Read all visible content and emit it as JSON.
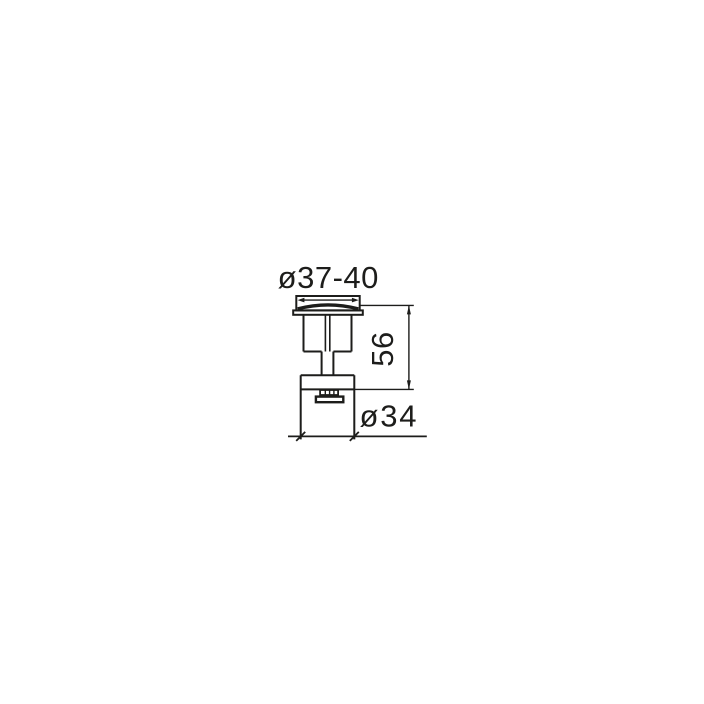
{
  "drawing": {
    "background_color": "#ffffff",
    "line_color": "#1d1d1b",
    "labels": {
      "cap_diameter": "ø37-40",
      "height": "56",
      "base_diameter": "ø34"
    }
  }
}
